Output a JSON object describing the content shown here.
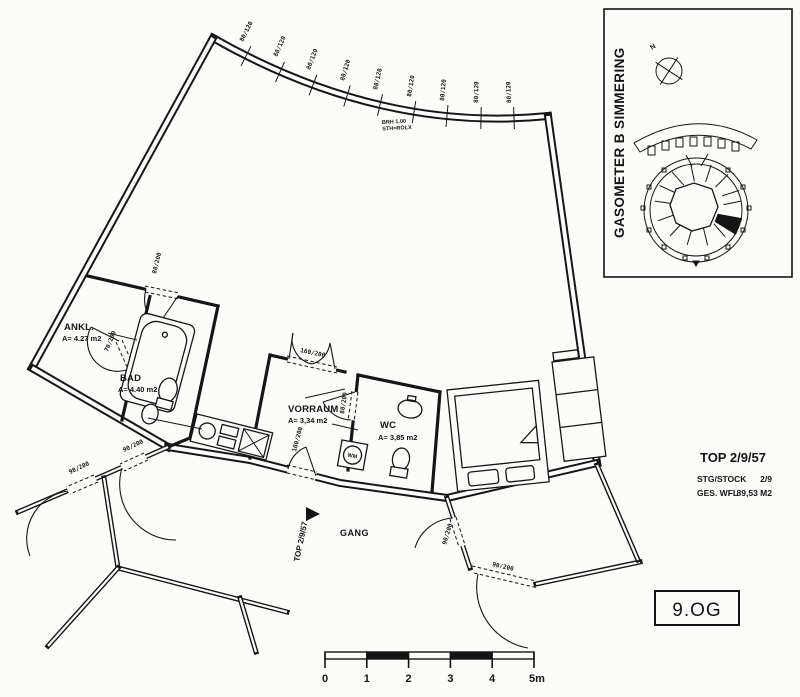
{
  "drawing": {
    "rooms": {
      "ankl": {
        "name": "ANKL.",
        "area": "A= 4.27 m2"
      },
      "bad": {
        "name": "BAD",
        "area": "A= 4.40 m2"
      },
      "vorraum": {
        "name": "VORRAUM",
        "area": "A= 3,34 m2"
      },
      "wc": {
        "name": "WC",
        "area": "A= 3,85 m2"
      },
      "gang": {
        "name": "GANG"
      }
    },
    "entrance": {
      "label": "TOP 2/9/57"
    },
    "window_note": {
      "line1": "BRH 1.00",
      "line2": "STH=ROLX"
    },
    "appliance": {
      "wm": "WM"
    },
    "dims": {
      "window": "80/120",
      "door_entry": "100/200",
      "door_std": "80/200",
      "door_small": "70/200",
      "door_double": "160/200",
      "door_neighbor": "90/200"
    }
  },
  "inset": {
    "title": "GASOMETER B SIMMERING",
    "north": "N"
  },
  "title_block": {
    "title": "TOP 2/9/57",
    "rows": [
      {
        "label": "STG/STOCK",
        "value": "2/9"
      },
      {
        "label": "GES. WFL",
        "value": "89,53 M2"
      }
    ]
  },
  "floor_badge": {
    "label": "9.OG"
  },
  "scale_bar": {
    "ticks": [
      "0",
      "1",
      "2",
      "3",
      "4",
      "5m"
    ]
  }
}
